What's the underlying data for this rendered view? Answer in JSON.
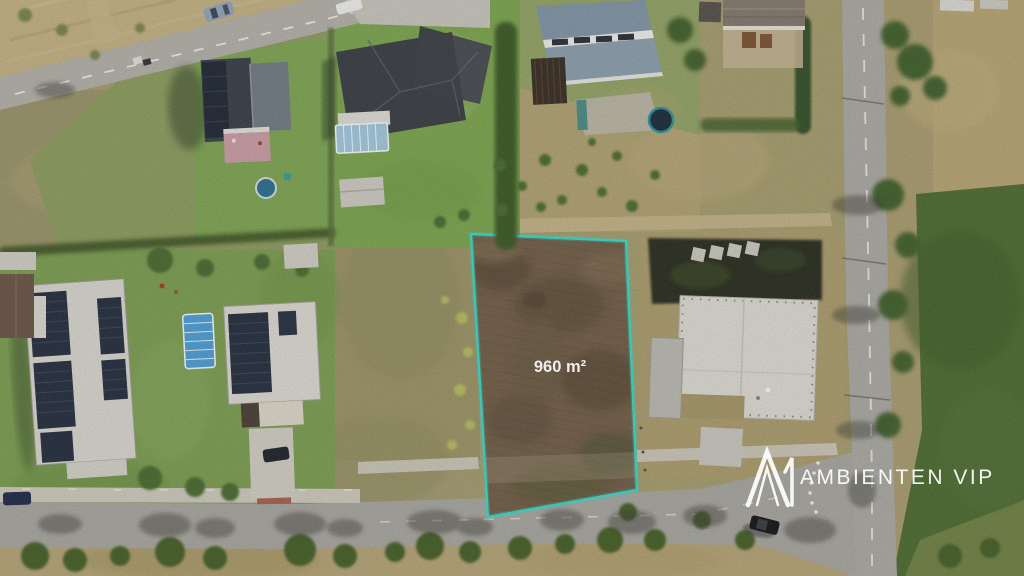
{
  "plot": {
    "area_label": "960 m²",
    "outline_color": "#38d6c7",
    "label_color": "#ffffff"
  },
  "watermark": {
    "text": "AMBIENTEN VIP",
    "color": "#ffffff",
    "logo_icon": "ambienten-mountain-logo"
  }
}
